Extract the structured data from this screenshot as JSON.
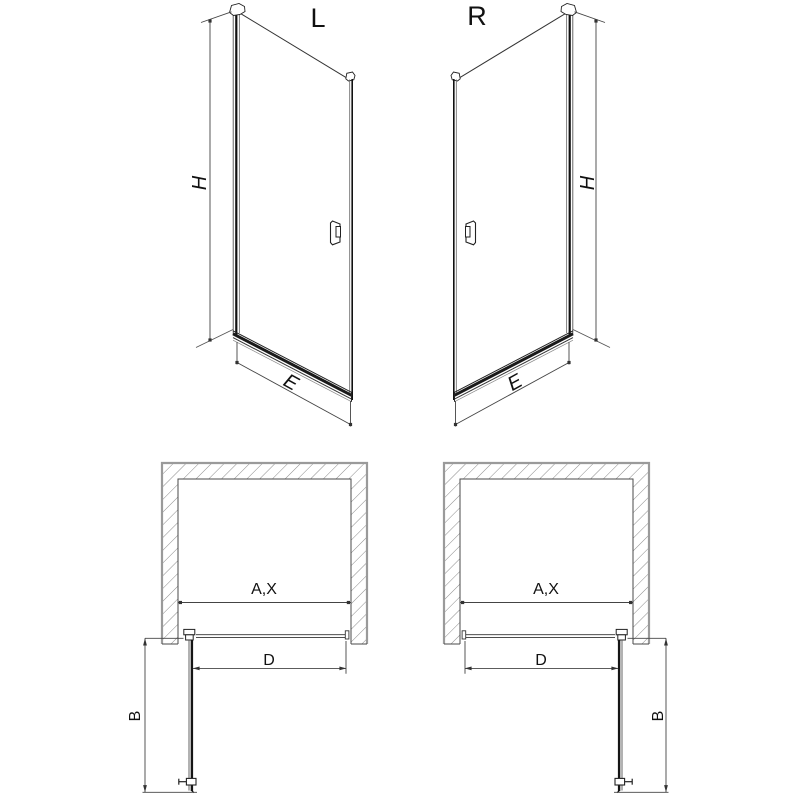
{
  "drawing": {
    "left_door": {
      "variant_label": "L",
      "height_dim": "H",
      "width_dim": "E",
      "plan": {
        "opening_dim": "A,X",
        "door_dim": "D",
        "swing_dim": "B"
      }
    },
    "right_door": {
      "variant_label": "R",
      "height_dim": "H",
      "width_dim": "E",
      "plan": {
        "opening_dim": "A,X",
        "door_dim": "D",
        "swing_dim": "B"
      }
    },
    "colors": {
      "line": "#1a1a1a",
      "dim_line": "#444444",
      "wall_outer": "#9a9a9a",
      "hatch": "#8a8a8a",
      "background": "#ffffff"
    }
  }
}
